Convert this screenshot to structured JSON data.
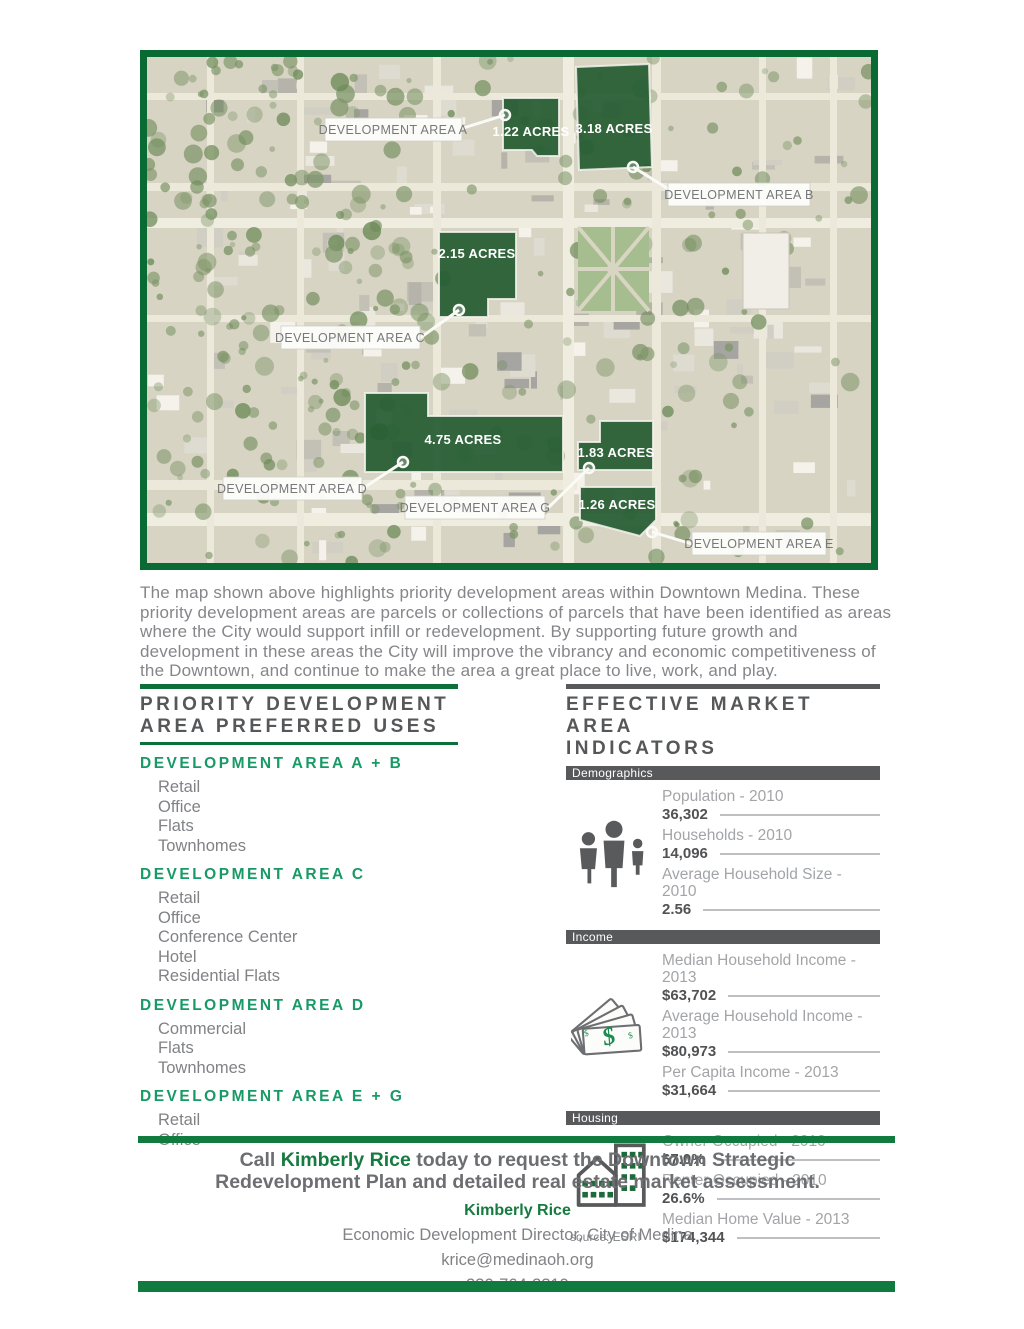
{
  "map": {
    "parcels": [
      {
        "acres": "1.22 ACRES"
      },
      {
        "acres": "3.18 ACRES"
      },
      {
        "acres": "2.15 ACRES"
      },
      {
        "acres": "4.75 ACRES"
      },
      {
        "acres": "1.83 ACRES"
      },
      {
        "acres": "1.26 ACRES"
      }
    ],
    "callouts": [
      {
        "label": "DEVELOPMENT AREA A"
      },
      {
        "label": "DEVELOPMENT AREA B"
      },
      {
        "label": "DEVELOPMENT AREA C"
      },
      {
        "label": "DEVELOPMENT AREA D"
      },
      {
        "label": "DEVELOPMENT AREA G"
      },
      {
        "label": "DEVELOPMENT AREA E"
      }
    ]
  },
  "intro": "The map shown above highlights priority development areas within Downtown Medina. These priority development areas are parcels or collections of parcels that have been identified as areas where the City would support infill or redevelopment. By supporting future growth and development in these areas the City will improve the vibrancy and economic competitiveness of the Downtown, and continue to make the area a great place to live, work, and play.",
  "left_column": {
    "title_line1": "PRIORITY DEVELOPMENT",
    "title_line2": "AREA PREFERRED USES",
    "sections": [
      {
        "heading": "DEVELOPMENT AREA A + B",
        "items": [
          "Retail",
          "Office",
          "Flats",
          "Townhomes"
        ]
      },
      {
        "heading": "DEVELOPMENT AREA C",
        "items": [
          "Retail",
          "Office",
          "Conference Center",
          "Hotel",
          "Residential Flats"
        ]
      },
      {
        "heading": "DEVELOPMENT AREA D",
        "items": [
          "Commercial",
          "Flats",
          "Townhomes"
        ]
      },
      {
        "heading": "DEVELOPMENT AREA E + G",
        "items": [
          "Retail",
          "Office"
        ]
      }
    ]
  },
  "right_column": {
    "title_line1": "EFFECTIVE MARKET AREA",
    "title_line2": "INDICATORS",
    "source": "source: ESRI",
    "sections": [
      {
        "name": "Demographics",
        "icon": "people-icon",
        "rows": [
          {
            "label": "Population - 2010",
            "value": "36,302"
          },
          {
            "label": "Households - 2010",
            "value": "14,096"
          },
          {
            "label": "Average Household Size - 2010",
            "value": "2.56"
          }
        ]
      },
      {
        "name": "Income",
        "icon": "money-icon",
        "rows": [
          {
            "label": "Median Household Income - 2013",
            "value": "$63,702"
          },
          {
            "label": "Average Household Income - 2013",
            "value": "$80,973"
          },
          {
            "label": "Per Capita Income - 2013",
            "value": "$31,664"
          }
        ]
      },
      {
        "name": "Housing",
        "icon": "buildings-icon",
        "rows": [
          {
            "label": "Owner Occupied - 2010",
            "value": "67.0%"
          },
          {
            "label": "Renter Occupied - 2010",
            "value": "26.6%"
          },
          {
            "label": "Median Home Value - 2013",
            "value": "$174,344"
          }
        ]
      }
    ]
  },
  "footer": {
    "call_prefix": "Call ",
    "call_name": "Kimberly Rice",
    "call_suffix": " today to request the Downtown Strategic Redevelopment Plan and detailed real estate market assessment.",
    "contact_name": "Kimberly Rice",
    "contact_title": "Economic Development Director, City of Medina",
    "email": "krice@medinaoh.org",
    "phone": "330-764-3319"
  },
  "colors": {
    "map_border_green": "#0a6a34",
    "rule_green": "#0d6f39",
    "footer_green": "#117a3e",
    "heading_green": "#189a66",
    "dark_gray": "#58595b",
    "parcel_green": "#265c33"
  }
}
